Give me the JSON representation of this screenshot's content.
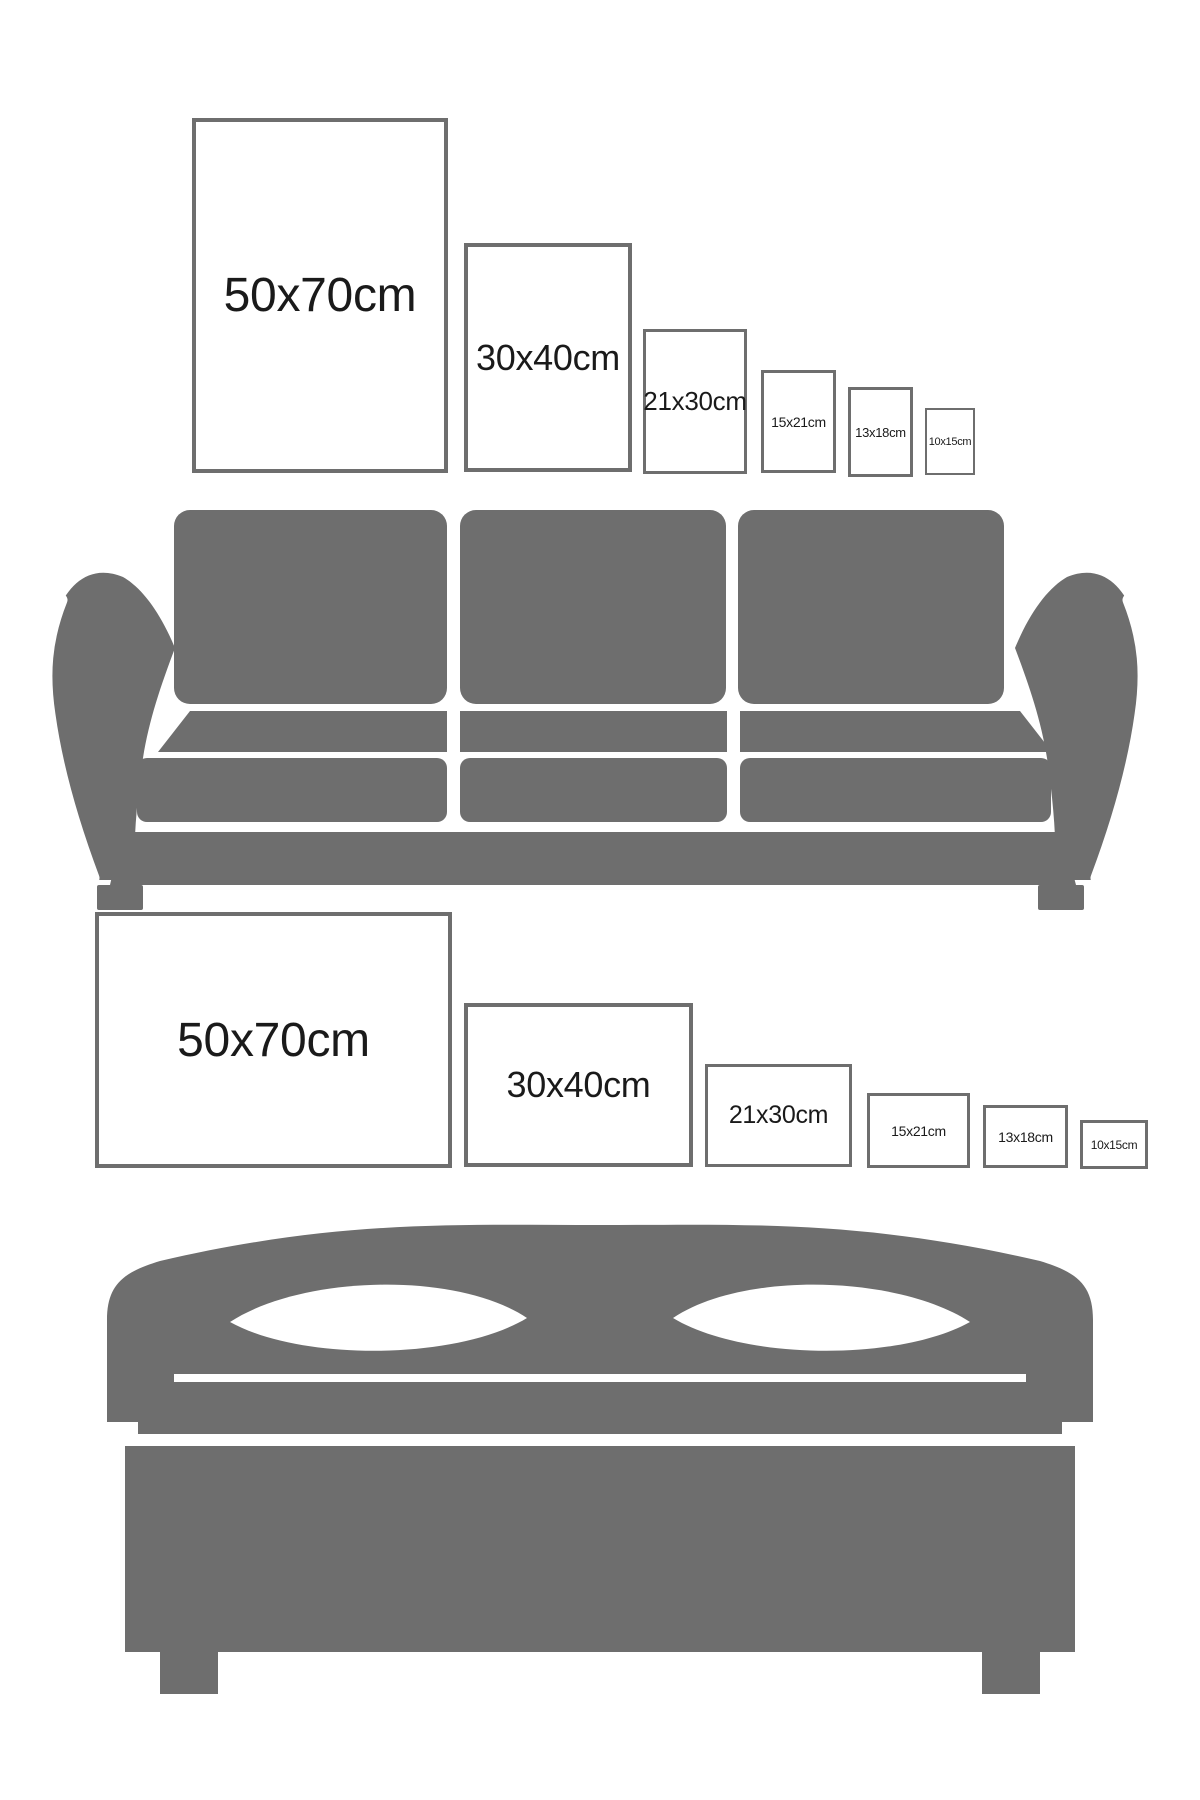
{
  "canvas": {
    "width": 1200,
    "height": 1800
  },
  "colors": {
    "background": "#ffffff",
    "furniture": "#6e6e6e",
    "frame_border": "#6e6e6e",
    "text": "#1a1a1a"
  },
  "sections": [
    {
      "id": "sofa-wall",
      "furniture": "sofa",
      "frames": [
        {
          "label": "50x70cm",
          "left": 192,
          "top": 118,
          "width": 256,
          "height": 355,
          "border": 4,
          "font": 48
        },
        {
          "label": "30x40cm",
          "left": 464,
          "top": 243,
          "width": 168,
          "height": 229,
          "border": 4,
          "font": 36
        },
        {
          "label": "21x30cm",
          "left": 643,
          "top": 329,
          "width": 104,
          "height": 145,
          "border": 3,
          "font": 26
        },
        {
          "label": "15x21cm",
          "left": 761,
          "top": 370,
          "width": 75,
          "height": 103,
          "border": 3,
          "font": 14
        },
        {
          "label": "13x18cm",
          "left": 848,
          "top": 387,
          "width": 65,
          "height": 90,
          "border": 3,
          "font": 13
        },
        {
          "label": "10x15cm",
          "left": 925,
          "top": 408,
          "width": 50,
          "height": 67,
          "border": 2,
          "font": 11
        }
      ]
    },
    {
      "id": "bed-wall",
      "furniture": "bed",
      "frames": [
        {
          "label": "50x70cm",
          "left": 95,
          "top": 912,
          "width": 357,
          "height": 256,
          "border": 4,
          "font": 48
        },
        {
          "label": "30x40cm",
          "left": 464,
          "top": 1003,
          "width": 229,
          "height": 164,
          "border": 4,
          "font": 36
        },
        {
          "label": "21x30cm",
          "left": 705,
          "top": 1064,
          "width": 147,
          "height": 103,
          "border": 3,
          "font": 25
        },
        {
          "label": "15x21cm",
          "left": 867,
          "top": 1093,
          "width": 103,
          "height": 75,
          "border": 3,
          "font": 14
        },
        {
          "label": "13x18cm",
          "left": 983,
          "top": 1105,
          "width": 85,
          "height": 63,
          "border": 3,
          "font": 14
        },
        {
          "label": "10x15cm",
          "left": 1080,
          "top": 1120,
          "width": 68,
          "height": 49,
          "border": 3,
          "font": 12
        }
      ]
    }
  ]
}
